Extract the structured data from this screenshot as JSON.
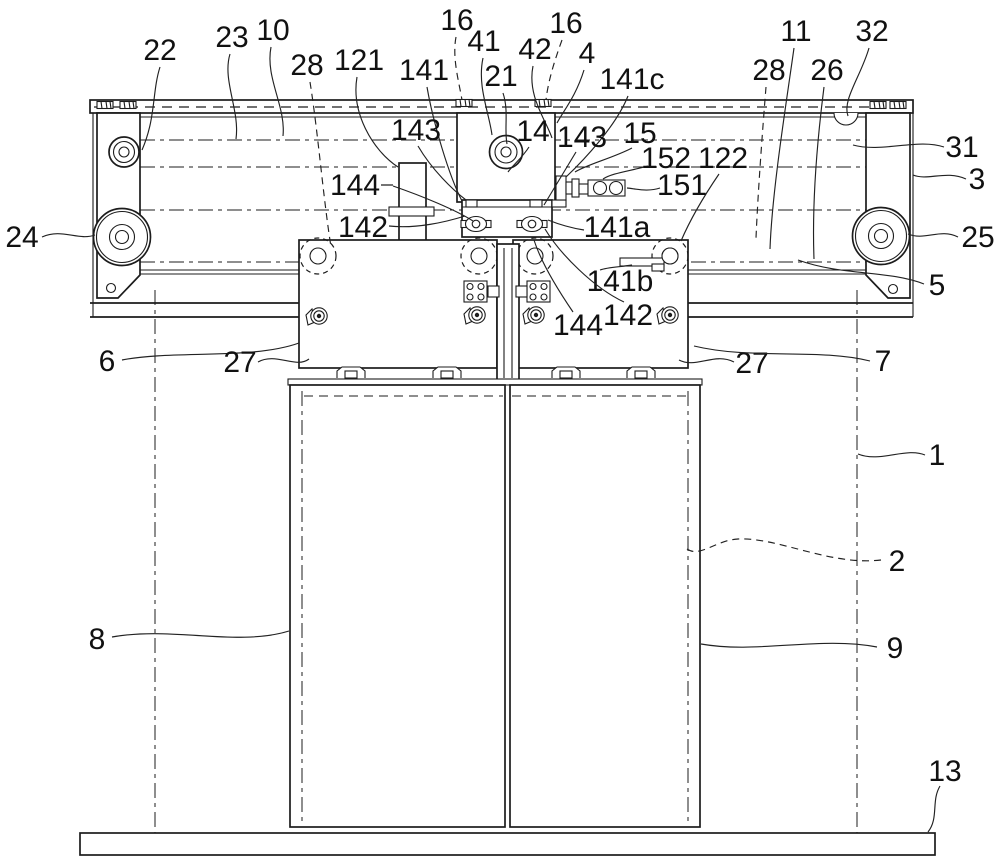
{
  "figure": {
    "type": "patent-line-drawing",
    "subject": "elevator door operator mechanism front view",
    "background_color": "#ffffff",
    "line_color": "#1c1c1c",
    "label_font_px": 30,
    "labels": [
      {
        "t": "22",
        "x": 160,
        "y": 50,
        "p": "M160,67 C152,92 156,118 142,150"
      },
      {
        "t": "23",
        "x": 232,
        "y": 37,
        "p": "M230,54 C222,80 240,110 236,139"
      },
      {
        "t": "10",
        "x": 273,
        "y": 30,
        "p": "M271,47 C265,78 286,106 283,136"
      },
      {
        "t": "28",
        "x": 307,
        "y": 65,
        "p": "M310,82 C318,132 323,196 331,247",
        "d": 1
      },
      {
        "t": "121",
        "x": 359,
        "y": 60,
        "p": "M357,77 C351,112 372,150 398,167"
      },
      {
        "t": "141",
        "x": 424,
        "y": 70,
        "p": "M427,87 C433,122 449,176 462,201"
      },
      {
        "t": "16",
        "x": 457,
        "y": 20,
        "p": "M456,37 C452,58 459,82 462,100",
        "d": 1
      },
      {
        "t": "41",
        "x": 484,
        "y": 41,
        "p": "M483,58 C477,86 489,112 492,135"
      },
      {
        "t": "21",
        "x": 501,
        "y": 76,
        "p": "M503,93 C509,111 504,129 507,144"
      },
      {
        "t": "42",
        "x": 535,
        "y": 49,
        "p": "M533,66 C527,96 546,120 552,138"
      },
      {
        "t": "16",
        "x": 566,
        "y": 23,
        "p": "M562,40 C554,62 548,82 546,100",
        "d": 1
      },
      {
        "t": "4",
        "x": 587,
        "y": 53,
        "p": "M584,70 C576,96 564,110 557,123"
      },
      {
        "t": "141c",
        "x": 632,
        "y": 79,
        "p": "M628,96 C616,126 584,160 566,177"
      },
      {
        "t": "143",
        "x": 416,
        "y": 130,
        "p": "M418,146 C432,170 453,190 466,200"
      },
      {
        "t": "14",
        "x": 533,
        "y": 131,
        "p": "M529,147 C522,158 513,165 508,172"
      },
      {
        "t": "143",
        "x": 582,
        "y": 137,
        "p": "M576,152 C564,172 552,192 544,205"
      },
      {
        "t": "15",
        "x": 640,
        "y": 133,
        "p": "M632,148 C613,158 588,164 575,172"
      },
      {
        "t": "152",
        "x": 666,
        "y": 158,
        "p": "M648,166 C630,171 612,173 603,179"
      },
      {
        "t": "122",
        "x": 723,
        "y": 158,
        "p": "M719,174 C704,196 690,220 681,241"
      },
      {
        "t": "151",
        "x": 682,
        "y": 185,
        "p": "M660,188 C648,192 637,189 627,188"
      },
      {
        "t": "11",
        "x": 796,
        "y": 31,
        "p": "M794,48 C786,105 772,192 770,249"
      },
      {
        "t": "28",
        "x": 769,
        "y": 70,
        "p": "M766,87 C762,137 758,192 756,238",
        "d": 1
      },
      {
        "t": "26",
        "x": 827,
        "y": 70,
        "p": "M824,87 C817,142 812,206 814,259"
      },
      {
        "t": "32",
        "x": 872,
        "y": 31,
        "p": "M869,48 C861,76 842,100 848,116"
      },
      {
        "t": "31",
        "x": 962,
        "y": 147,
        "p": "M944,147 C918,138 882,153 853,145"
      },
      {
        "t": "3",
        "x": 977,
        "y": 179,
        "p": "M966,179 C946,170 928,181 913,175"
      },
      {
        "t": "24",
        "x": 22,
        "y": 237,
        "p": "M42,237 C62,228 78,241 95,235"
      },
      {
        "t": "25",
        "x": 978,
        "y": 237,
        "p": "M958,237 C940,228 925,241 908,234"
      },
      {
        "t": "5",
        "x": 937,
        "y": 285,
        "p": "M924,284 C888,270 842,276 798,260"
      },
      {
        "t": "6",
        "x": 107,
        "y": 361,
        "p": "M122,360 C172,350 252,360 299,343"
      },
      {
        "t": "27",
        "x": 240,
        "y": 362,
        "p": "M258,362 C276,352 296,369 309,359"
      },
      {
        "t": "27",
        "x": 752,
        "y": 363,
        "p": "M734,362 C714,352 696,369 679,360"
      },
      {
        "t": "7",
        "x": 883,
        "y": 361,
        "p": "M870,361 C818,348 752,360 694,346"
      },
      {
        "t": "8",
        "x": 97,
        "y": 639,
        "p": "M112,637 C172,626 237,647 289,631"
      },
      {
        "t": "9",
        "x": 895,
        "y": 648,
        "p": "M877,647 C820,636 757,654 701,644"
      },
      {
        "t": "1",
        "x": 937,
        "y": 455,
        "p": "M925,455 C906,447 880,463 858,454"
      },
      {
        "t": "2",
        "x": 897,
        "y": 561,
        "p": "M881,560 C830,566 778,537 738,539 C716,540 700,558 687,549",
        "d": 1
      },
      {
        "t": "13",
        "x": 945,
        "y": 771,
        "p": "M940,786 C931,801 939,818 928,832"
      },
      {
        "t": "144",
        "x": 355,
        "y": 185,
        "p": "M381,185 L393,185 M393,186 C422,196 456,210 473,221"
      },
      {
        "t": "142",
        "x": 363,
        "y": 227,
        "p": "M389,226 C416,229 446,222 465,216"
      },
      {
        "t": "141a",
        "x": 617,
        "y": 227,
        "p": "M584,230 C571,228 558,224 548,220"
      },
      {
        "t": "141b",
        "x": 620,
        "y": 281,
        "p": "M600,270 C608,267 620,267 632,265"
      },
      {
        "t": "142",
        "x": 628,
        "y": 315,
        "p": "M624,302 C594,288 560,254 545,229"
      },
      {
        "t": "144",
        "x": 578,
        "y": 325,
        "p": "M573,312 C558,290 541,262 534,240"
      }
    ]
  }
}
